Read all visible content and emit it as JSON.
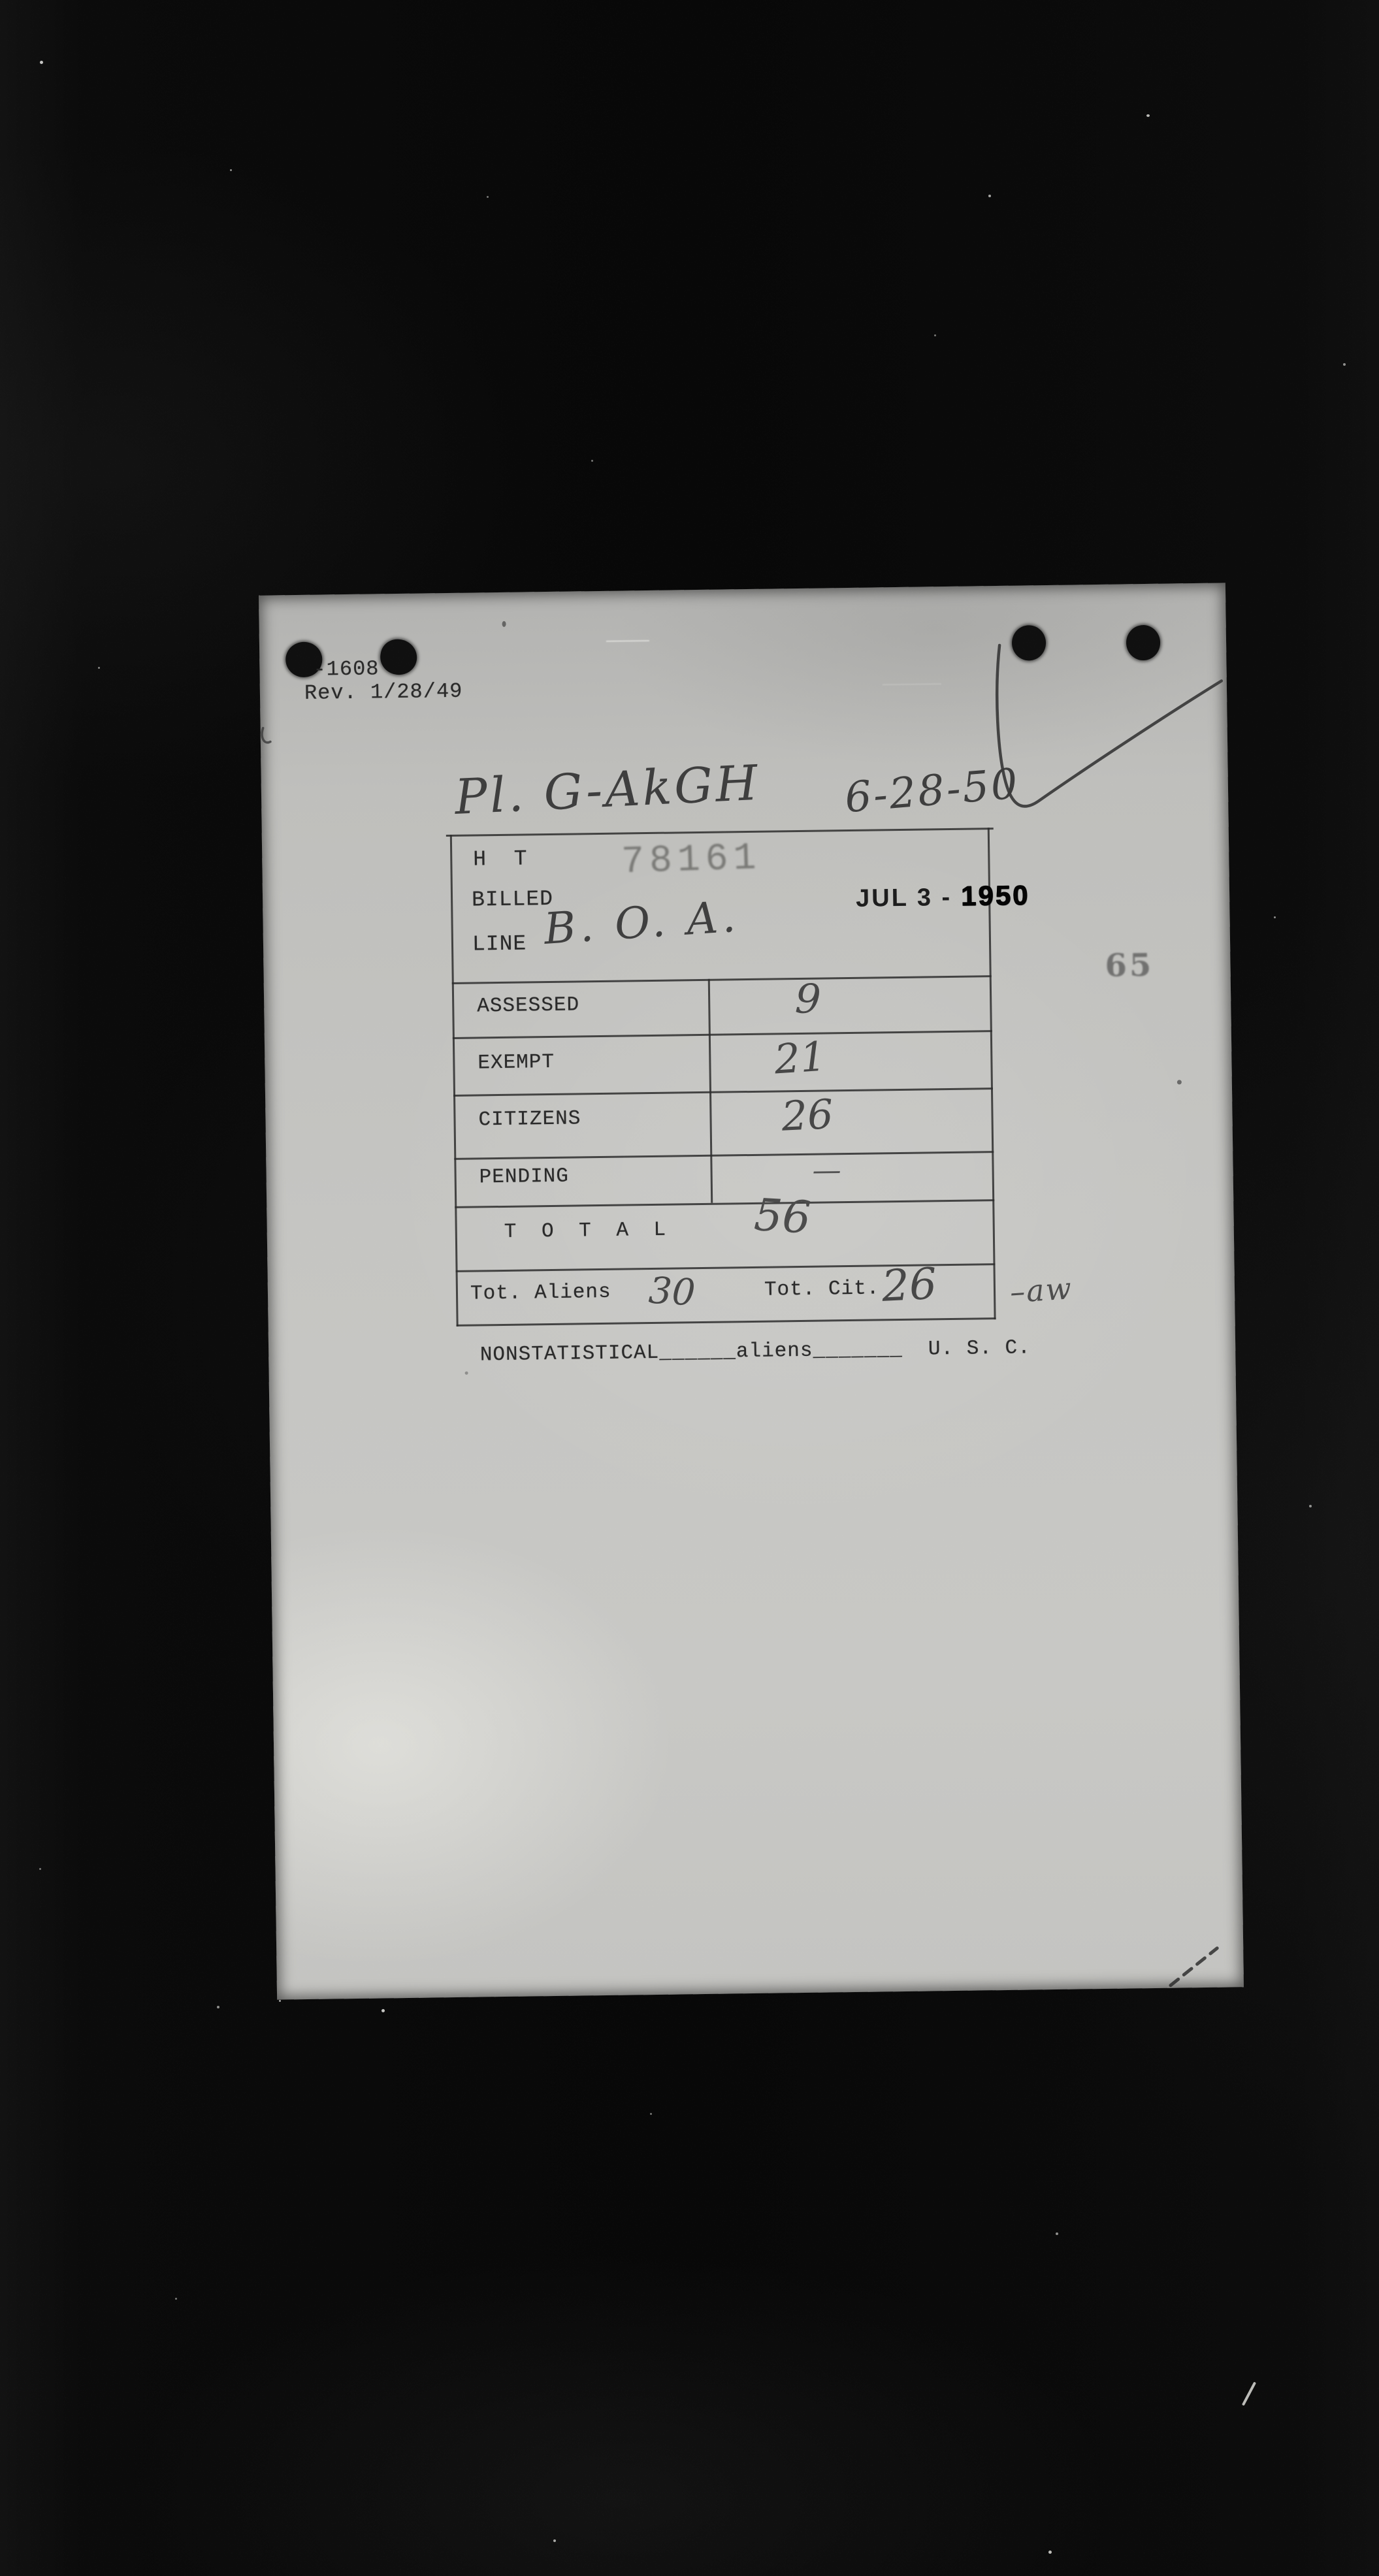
{
  "colors": {
    "background": "#0a0a0a",
    "paper": "#c5c5c2",
    "typed_ink": "#2a2a2a",
    "pencil": "#474747",
    "stamp_faded": "#767673",
    "stamp_dark": "#0a0a0a"
  },
  "scan": {
    "margin_number": "65",
    "form": {
      "form_id": "-1608",
      "revision": "Rev. 1/28/49",
      "handwritten_route": "Pl. G-AkGH",
      "handwritten_date": "6-28-50",
      "header": {
        "ht_label": "H  T",
        "billed_label": "BILLED",
        "line_label": "LINE",
        "line_value_handwritten": "B. O. A.",
        "serial_stamp": "78161",
        "date_stamp": "JUL 3 - ",
        "date_stamp_year": "1950"
      },
      "rows": [
        {
          "label": "ASSESSED",
          "value": "9"
        },
        {
          "label": "EXEMPT",
          "value": "21"
        },
        {
          "label": "CITIZENS",
          "value": "26"
        },
        {
          "label": "PENDING",
          "value": "—"
        }
      ],
      "total_row": {
        "label": "T O T A L",
        "value": "56"
      },
      "totals_row": {
        "aliens_label": "Tot. Aliens",
        "aliens_value": "30",
        "citizens_label": "Tot. Cit.",
        "citizens_value": "26"
      },
      "footer": {
        "nonstatistical_label": "NONSTATISTICAL",
        "blank1": "______",
        "aliens_label": "aliens",
        "blank2": "_______",
        "usc_label": "  U. S. C."
      },
      "side_annotation": "–aw"
    }
  }
}
